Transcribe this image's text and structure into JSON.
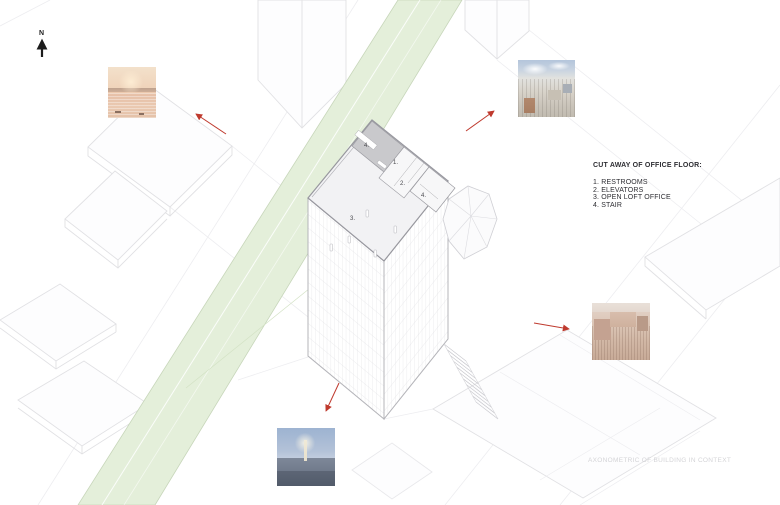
{
  "page": {
    "north_label": "N",
    "caption": "AXONOMETRIC OF BUILDING IN CONTEXT",
    "legend": {
      "title": "CUT AWAY OF OFFICE FLOOR:",
      "items": [
        "1. RESTROOMS",
        "2. ELEVATORS",
        "3. OPEN LOFT OFFICE",
        "4. STAIR"
      ]
    },
    "plan_labels": {
      "stair_north": "4.",
      "restrooms": "1.",
      "elevators": "2.",
      "stair_east": "4.",
      "open_loft": "3."
    },
    "colors": {
      "park_green": "#e4efda",
      "arrow_red": "#bf3a2e",
      "drawing_line_light": "#e1e1e4",
      "drawing_line_dark": "#97979e",
      "legend_text": "#2e2e33",
      "caption_text": "#d4d4d7"
    }
  }
}
